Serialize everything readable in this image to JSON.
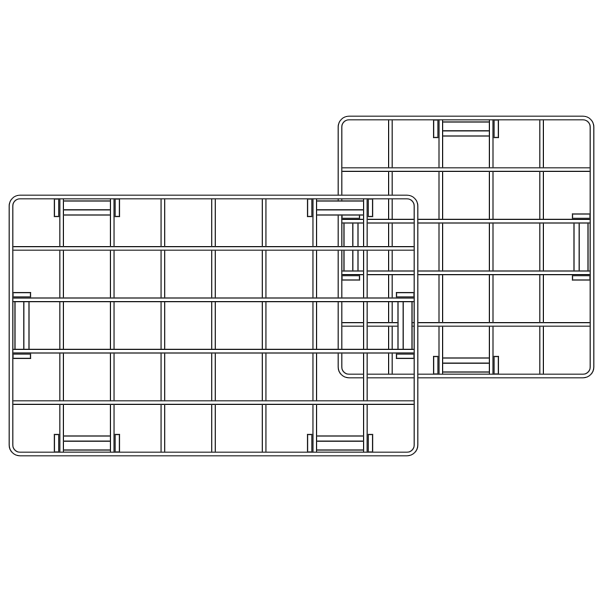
{
  "scene": {
    "name": "two-wire-grid-panels-illustration",
    "background_color": "#ffffff",
    "line_color": "#222222",
    "wire_core_color": "#ffffff",
    "canvas": {
      "width": 600,
      "height": 600
    },
    "wire_style": {
      "tube_outer_width": 4.8,
      "tube_core_width": 2.4,
      "clip_outline_width": 1.3,
      "corner_radius": 9,
      "clip_channel_inset_near": 4,
      "clip_channel_inset_far": 18,
      "clip_inner_line_inset": 12.8,
      "clip_tab_thickness": 4.4,
      "clip_tab_length": 17.5,
      "clip_tab_near_offset": 2,
      "clip_tab_gap": 2.8
    },
    "panels": [
      {
        "name": "back-panel",
        "description": "wire grid panel 5x5",
        "left": 340,
        "top": 118,
        "right": 592,
        "bottom": 376,
        "columns": 5,
        "rows": 5,
        "clips": [
          {
            "edge": "top",
            "cell": 3
          },
          {
            "edge": "bottom",
            "cell": 3
          },
          {
            "edge": "left",
            "cell": 3
          },
          {
            "edge": "right",
            "cell": 3
          }
        ]
      },
      {
        "name": "front-panel",
        "description": "wire grid panel 8x5",
        "left": 11,
        "top": 197,
        "right": 416,
        "bottom": 454,
        "columns": 8,
        "rows": 5,
        "clips": [
          {
            "edge": "top",
            "cell": 2
          },
          {
            "edge": "top",
            "cell": 7
          },
          {
            "edge": "bottom",
            "cell": 2
          },
          {
            "edge": "bottom",
            "cell": 7
          },
          {
            "edge": "left",
            "cell": 3
          },
          {
            "edge": "right",
            "cell": 3
          }
        ]
      }
    ]
  }
}
